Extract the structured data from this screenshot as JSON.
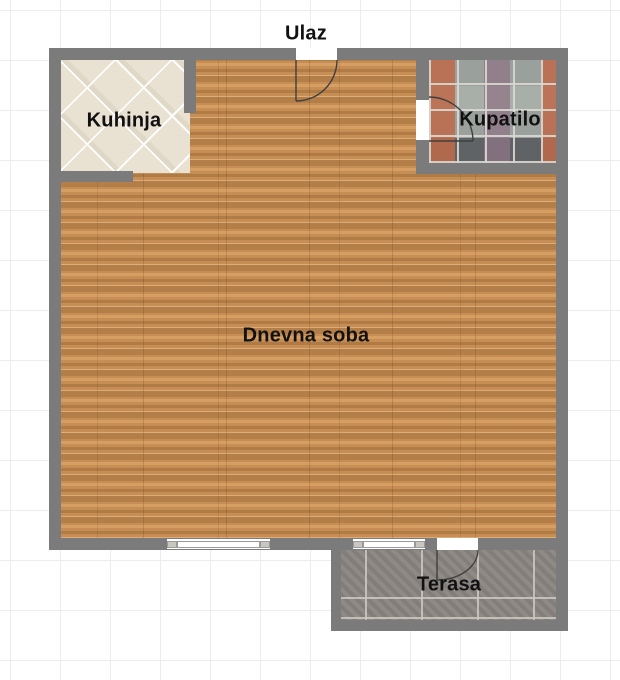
{
  "rooms": {
    "entrance": {
      "label": "Ulaz"
    },
    "kitchen": {
      "label": "Kuhinja"
    },
    "bathroom": {
      "label": "Kupatilo"
    },
    "living_room": {
      "label": "Dnevna soba"
    },
    "terrace": {
      "label": "Terasa"
    }
  },
  "colors": {
    "background": "#ffffff",
    "grid_line": "#ececec",
    "wall": "#7b7b7b",
    "wood_floor": "#c68e55",
    "kitchen_floor": "#e9e1d1",
    "bathroom_tile_base": "#9aa19c",
    "bathroom_tile_accent": "#bf6a4a",
    "terrace_floor": "#8a8581",
    "door_arc": "#3f3f3f",
    "label_text": "#111111"
  }
}
